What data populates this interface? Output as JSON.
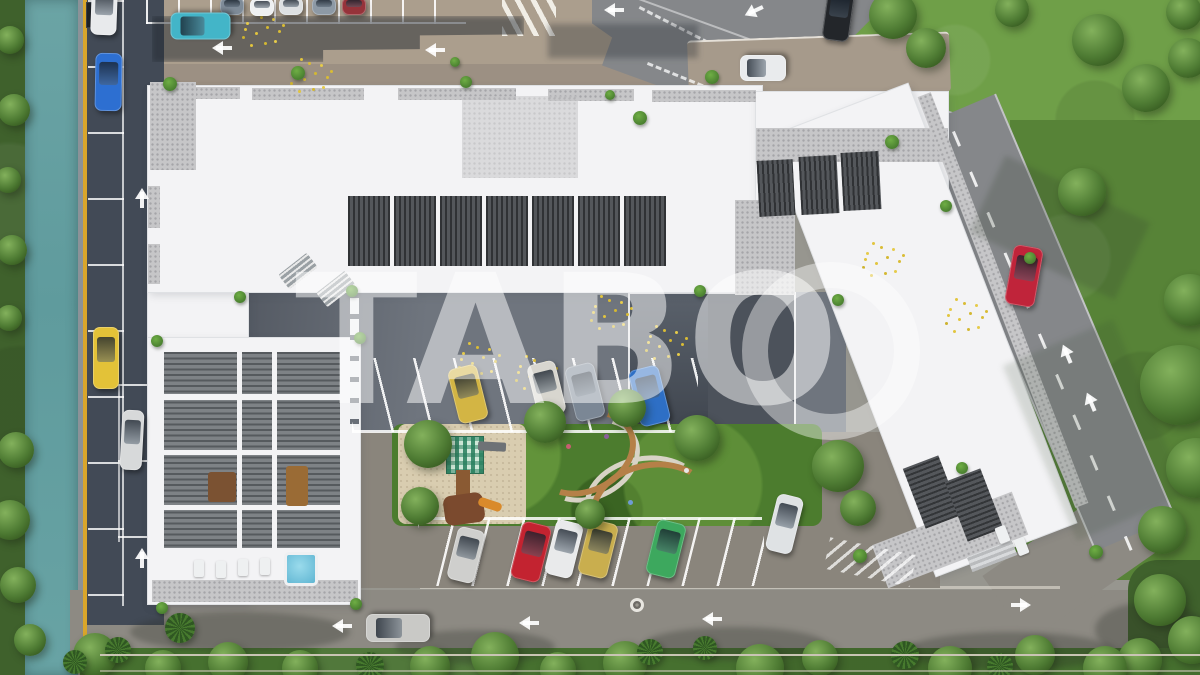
{
  "scene": {
    "watermark_text": "TABO",
    "description": "aerial 3d render of residential complex with courtyard parking, canal and roads",
    "cars": [
      {
        "name": "car-white-parked-left-top",
        "color": "#e8eaec",
        "x": 104,
        "y": 12,
        "w": 26,
        "h": 46,
        "rot": 2
      },
      {
        "name": "car-blue-parked-left",
        "color": "#2d6fd1",
        "x": 108,
        "y": 82,
        "w": 27,
        "h": 58,
        "rot": 1
      },
      {
        "name": "car-yellow-parked-left",
        "color": "#e3c238",
        "x": 106,
        "y": 358,
        "w": 26,
        "h": 62,
        "rot": 0
      },
      {
        "name": "car-silver-parked-left",
        "color": "#d7d9da",
        "x": 132,
        "y": 440,
        "w": 22,
        "h": 60,
        "rot": 3
      },
      {
        "name": "car-slate-parked-top",
        "color": "#7e8b98",
        "x": 232,
        "y": 6,
        "w": 24,
        "h": 18,
        "rot": 0
      },
      {
        "name": "car-white-parked-top",
        "color": "#eef0f1",
        "x": 262,
        "y": 7,
        "w": 24,
        "h": 18,
        "rot": 0
      },
      {
        "name": "car-white-parked-top-2",
        "color": "#dde0e2",
        "x": 291,
        "y": 6,
        "w": 24,
        "h": 18,
        "rot": 0
      },
      {
        "name": "car-steel-parked-top",
        "color": "#8d99a5",
        "x": 324,
        "y": 6,
        "w": 24,
        "h": 18,
        "rot": 0
      },
      {
        "name": "car-red-parked-top",
        "color": "#96333a",
        "x": 354,
        "y": 6,
        "w": 24,
        "h": 18,
        "rot": 0
      },
      {
        "name": "car-teal-driving-top-road",
        "color": "#43b5c8",
        "x": 200,
        "y": 26,
        "w": 27,
        "h": 60,
        "rot": -90
      },
      {
        "name": "car-black-suv-top",
        "color": "#23262a",
        "x": 838,
        "y": 14,
        "w": 27,
        "h": 54,
        "rot": 8
      },
      {
        "name": "car-white-parked-driveway",
        "color": "#e9ebed",
        "x": 763,
        "y": 68,
        "w": 26,
        "h": 46,
        "rot": -90
      },
      {
        "name": "car-red-driving-right-road",
        "color": "#c0243a",
        "x": 1024,
        "y": 276,
        "w": 30,
        "h": 60,
        "rot": 10
      },
      {
        "name": "car-white-driving-bottom-driveway",
        "color": "#dfe2e4",
        "x": 784,
        "y": 524,
        "w": 27,
        "h": 58,
        "rot": 14
      },
      {
        "name": "car-silver-driving-bottom-road",
        "color": "#c9c9c6",
        "x": 398,
        "y": 628,
        "w": 28,
        "h": 64,
        "rot": -90
      },
      {
        "name": "car-yellow-courtyard",
        "color": "#d3b544",
        "x": 468,
        "y": 394,
        "w": 30,
        "h": 56,
        "rot": -14
      },
      {
        "name": "car-white-courtyard",
        "color": "#d8d6cf",
        "x": 546,
        "y": 389,
        "w": 29,
        "h": 54,
        "rot": -14
      },
      {
        "name": "car-gray-courtyard",
        "color": "#7b8795",
        "x": 585,
        "y": 392,
        "w": 30,
        "h": 56,
        "rot": -14
      },
      {
        "name": "car-blue-courtyard",
        "color": "#2e6fc5",
        "x": 649,
        "y": 396,
        "w": 31,
        "h": 58,
        "rot": -14
      },
      {
        "name": "car-silver-courtyard",
        "color": "#cfcfcd",
        "x": 466,
        "y": 555,
        "w": 28,
        "h": 54,
        "rot": 14
      },
      {
        "name": "car-red-courtyard",
        "color": "#c32330",
        "x": 531,
        "y": 552,
        "w": 30,
        "h": 58,
        "rot": 14
      },
      {
        "name": "car-white-courtyard-2",
        "color": "#e9eaeb",
        "x": 564,
        "y": 549,
        "w": 28,
        "h": 56,
        "rot": 14
      },
      {
        "name": "car-gold-courtyard",
        "color": "#c9ae4e",
        "x": 598,
        "y": 549,
        "w": 30,
        "h": 56,
        "rot": 14
      },
      {
        "name": "car-green-courtyard",
        "color": "#3da85e",
        "x": 666,
        "y": 549,
        "w": 30,
        "h": 56,
        "rot": 14
      }
    ],
    "trees": [
      [
        893,
        15,
        24,
        "leafy"
      ],
      [
        926,
        48,
        20,
        "leafy"
      ],
      [
        1012,
        10,
        17,
        "leafy"
      ],
      [
        1098,
        40,
        26,
        "leafy"
      ],
      [
        1146,
        88,
        24,
        "leafy"
      ],
      [
        1188,
        58,
        20,
        "leafy"
      ],
      [
        1184,
        12,
        18,
        "leafy"
      ],
      [
        1082,
        192,
        24,
        "leafy"
      ],
      [
        1190,
        300,
        26,
        "leafy"
      ],
      [
        1180,
        385,
        40,
        "leafy"
      ],
      [
        1196,
        468,
        30,
        "leafy"
      ],
      [
        1162,
        530,
        24,
        "leafy"
      ],
      [
        1160,
        600,
        26,
        "leafy"
      ],
      [
        1192,
        640,
        24,
        "leafy"
      ],
      [
        1140,
        660,
        22,
        "leafy"
      ],
      [
        95,
        655,
        22,
        "leafy"
      ],
      [
        163,
        668,
        18,
        "leafy"
      ],
      [
        228,
        662,
        20,
        "leafy"
      ],
      [
        300,
        668,
        18,
        "leafy"
      ],
      [
        430,
        666,
        20,
        "leafy"
      ],
      [
        495,
        656,
        24,
        "leafy"
      ],
      [
        558,
        670,
        18,
        "leafy"
      ],
      [
        625,
        663,
        22,
        "leafy"
      ],
      [
        760,
        668,
        24,
        "leafy"
      ],
      [
        820,
        658,
        18,
        "leafy"
      ],
      [
        950,
        668,
        22,
        "leafy"
      ],
      [
        1035,
        655,
        20,
        "leafy"
      ],
      [
        1105,
        668,
        22,
        "leafy"
      ],
      [
        180,
        628,
        15,
        "palm"
      ],
      [
        370,
        666,
        14,
        "palm"
      ],
      [
        650,
        652,
        13,
        "palm"
      ],
      [
        705,
        648,
        12,
        "palm"
      ],
      [
        905,
        655,
        14,
        "palm"
      ],
      [
        1000,
        666,
        13,
        "palm"
      ],
      [
        118,
        650,
        13,
        "palm"
      ],
      [
        75,
        662,
        12,
        "palm"
      ],
      [
        10,
        40,
        14,
        "leafy"
      ],
      [
        14,
        110,
        16,
        "leafy"
      ],
      [
        8,
        180,
        13,
        "leafy"
      ],
      [
        12,
        250,
        15,
        "leafy"
      ],
      [
        9,
        318,
        13,
        "leafy"
      ],
      [
        16,
        450,
        18,
        "leafy"
      ],
      [
        10,
        520,
        20,
        "leafy"
      ],
      [
        18,
        585,
        18,
        "leafy"
      ],
      [
        30,
        640,
        16,
        "leafy"
      ],
      [
        428,
        444,
        24,
        "leafy"
      ],
      [
        545,
        422,
        21,
        "leafy"
      ],
      [
        627,
        408,
        19,
        "leafy"
      ],
      [
        697,
        438,
        23,
        "leafy"
      ],
      [
        838,
        466,
        26,
        "leafy"
      ],
      [
        858,
        508,
        18,
        "leafy"
      ],
      [
        420,
        506,
        19,
        "leafy"
      ],
      [
        590,
        514,
        15,
        "leafy"
      ],
      [
        170,
        84,
        7,
        "shrub"
      ],
      [
        298,
        73,
        7,
        "shrub"
      ],
      [
        466,
        82,
        6,
        "shrub"
      ],
      [
        640,
        118,
        7,
        "shrub"
      ],
      [
        712,
        77,
        7,
        "shrub"
      ],
      [
        892,
        142,
        7,
        "shrub"
      ],
      [
        946,
        206,
        6,
        "shrub"
      ],
      [
        1030,
        258,
        6,
        "shrub"
      ],
      [
        240,
        297,
        6,
        "shrub"
      ],
      [
        352,
        291,
        6,
        "shrub"
      ],
      [
        700,
        291,
        6,
        "shrub"
      ],
      [
        157,
        341,
        6,
        "shrub"
      ],
      [
        360,
        338,
        6,
        "shrub"
      ],
      [
        162,
        608,
        6,
        "shrub"
      ],
      [
        356,
        604,
        6,
        "shrub"
      ],
      [
        860,
        556,
        7,
        "shrub"
      ],
      [
        1096,
        552,
        7,
        "shrub"
      ],
      [
        962,
        468,
        6,
        "shrub"
      ],
      [
        838,
        300,
        6,
        "shrub"
      ],
      [
        455,
        62,
        5,
        "shrub"
      ],
      [
        610,
        95,
        5,
        "shrub"
      ]
    ],
    "arrows": [
      [
        142,
        196,
        0
      ],
      [
        142,
        556,
        0
      ],
      [
        220,
        48,
        -90
      ],
      [
        433,
        50,
        -90
      ],
      [
        612,
        10,
        -90
      ],
      [
        752,
        12,
        -115
      ],
      [
        1066,
        352,
        -23
      ],
      [
        1090,
        400,
        -23
      ],
      [
        340,
        626,
        -90
      ],
      [
        527,
        623,
        -90
      ],
      [
        710,
        619,
        -90
      ],
      [
        1023,
        605,
        90
      ]
    ],
    "petals": [
      [
        252,
        12
      ],
      [
        300,
        58
      ],
      [
        468,
        342
      ],
      [
        600,
        295
      ],
      [
        655,
        325
      ],
      [
        872,
        242
      ],
      [
        955,
        298
      ],
      [
        525,
        355
      ]
    ]
  },
  "palette": {
    "base": "#97968f",
    "canal": "#66a1a3",
    "veg": "#3f612c",
    "grass": "#6f9f48",
    "grass_dark": "#578337",
    "asphalt": "#424a56",
    "pave_beige": "#ab9e8d",
    "road_gray": "#85878a",
    "bottom_road": "#8d8a83",
    "roof": "#f3f3f5",
    "terrace": "#c6c6c8",
    "louver": "#54575b",
    "court": "#6f757e",
    "court_brown": "#8a857c",
    "lawn": "#4c7c2e",
    "sand": "#d9cdb0",
    "pool": "#7cc7de",
    "line_white": "#ffffff",
    "line_yellow": "#d9a62b",
    "watermark": "#ffffff"
  }
}
